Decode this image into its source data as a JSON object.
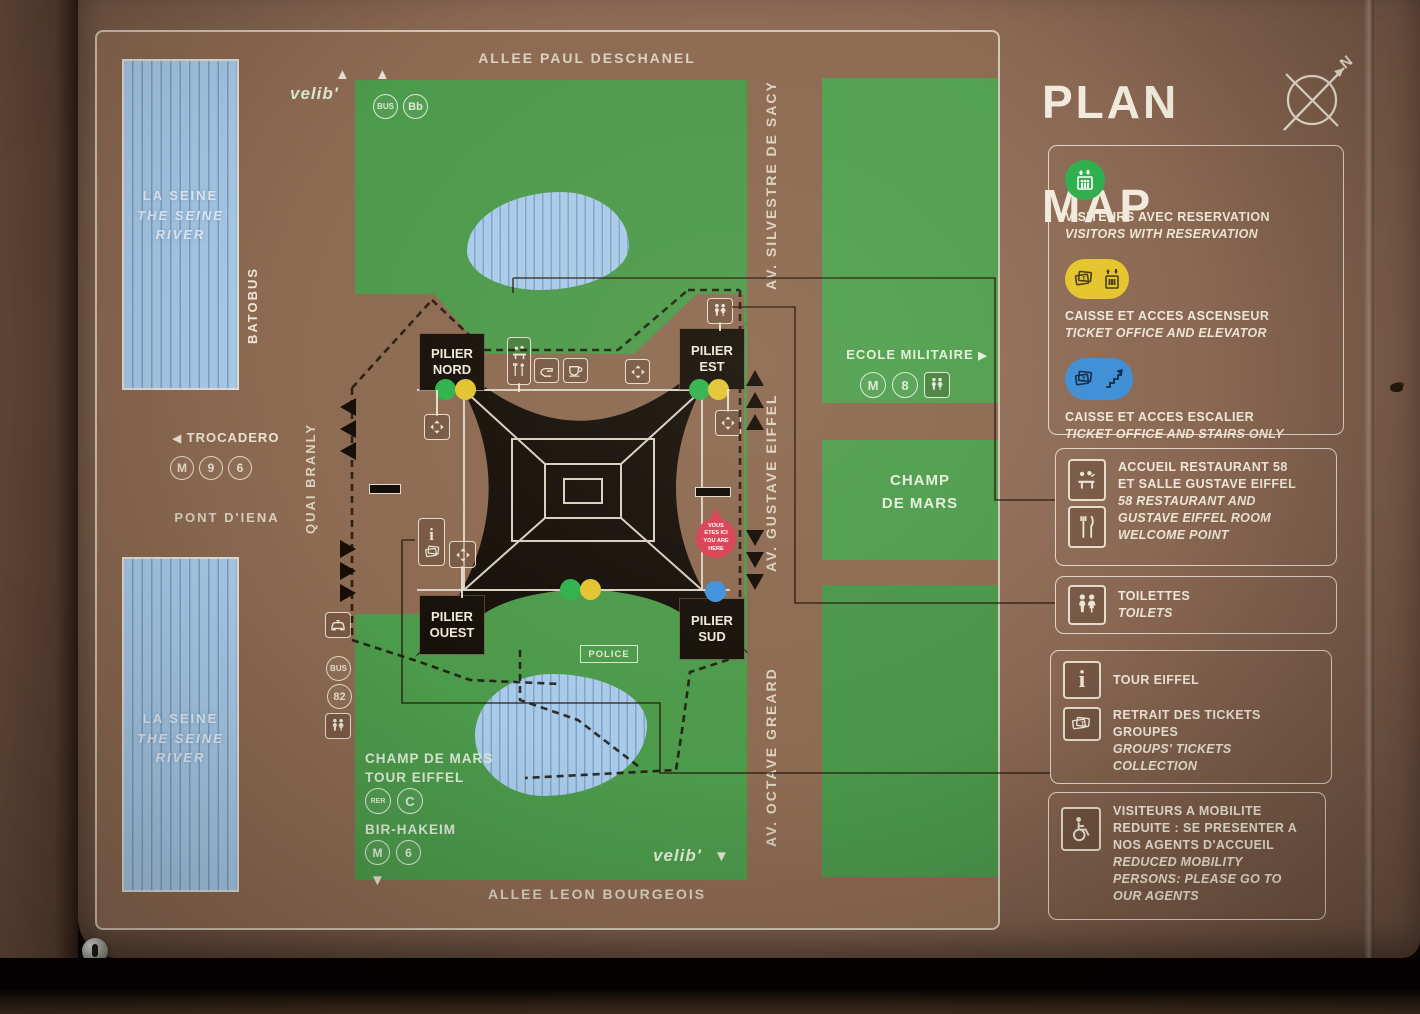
{
  "title": {
    "line1": "PLAN",
    "line2": "MAP",
    "compass_n": "N"
  },
  "colors": {
    "panel_brown": "#8a6853",
    "park_green": "#4c9a4b",
    "river_blue": "#a9cbe8",
    "tower_black": "#16100a",
    "cream": "#ece4d4",
    "dot_green": "#2eb24a",
    "dot_yellow": "#e3c430",
    "dot_blue": "#3e92dd",
    "marker_red": "#d94054"
  },
  "icons": {
    "arrow_left": "◀",
    "arrow_right": "▶",
    "arrow_up": "▲",
    "arrow_down": "▼",
    "info_glyph": "i"
  },
  "map": {
    "roads": {
      "allee_paul_deschanel": "ALLEE PAUL DESCHANEL",
      "allee_leon_bourgeois": "ALLEE LEON BOURGEOIS",
      "quai_branly": "QUAI BRANLY",
      "av_silvestre_de_sacy": "AV. SILVESTRE DE SACY",
      "av_gustave_eiffel": "AV. GUSTAVE EIFFEL",
      "av_octave_greard": "AV. OCTAVE GREARD",
      "pont_d_iena": "PONT D'IENA"
    },
    "river": {
      "line1": "LA SEINE",
      "line2": "THE SEINE",
      "line3": "RIVER",
      "batobus": "BATOBUS"
    },
    "transit": {
      "trocadero": {
        "label": "TROCADERO",
        "badges": [
          "M",
          "9",
          "6"
        ]
      },
      "ecole_militaire": {
        "label": "ECOLE MILITAIRE",
        "badges": [
          "M",
          "8"
        ]
      },
      "champ_de_mars_rer": {
        "line1": "CHAMP DE MARS",
        "line2": "TOUR EIFFEL",
        "badges": [
          "RER",
          "C"
        ]
      },
      "bir_hakeim": {
        "label": "BIR-HAKEIM",
        "badges": [
          "M",
          "6"
        ]
      },
      "bus_quai": {
        "badges": [
          "BUS",
          "82"
        ]
      },
      "bus_top": {
        "badges": [
          "BUS",
          "Bb"
        ]
      }
    },
    "areas": {
      "champ_de_mars": "CHAMP\nDE MARS"
    },
    "pillars": {
      "nord": "PILIER\nNORD",
      "est": "PILIER\nEST",
      "ouest": "PILIER\nOUEST",
      "sud": "PILIER\nSUD"
    },
    "police": "POLICE",
    "you_are_here": "VOUS\nETES ICI\nYOU ARE\nHERE",
    "velib": "velib'"
  },
  "legend": {
    "reservation": {
      "fr": "VISITEURS AVEC RESERVATION",
      "en": "VISITORS WITH RESERVATION"
    },
    "elevator": {
      "fr": "CAISSE ET ACCES ASCENSEUR",
      "en": "TICKET OFFICE AND ELEVATOR"
    },
    "stairs": {
      "fr": "CAISSE ET ACCES ESCALIER",
      "en": "TICKET OFFICE AND STAIRS ONLY"
    },
    "restaurant": {
      "fr": "ACCUEIL RESTAURANT 58\nET SALLE GUSTAVE EIFFEL",
      "en": "58 RESTAURANT AND\nGUSTAVE EIFFEL ROOM\nWELCOME POINT"
    },
    "toilets": {
      "fr": "TOILETTES",
      "en": "TOILETS"
    },
    "tour_eiffel": {
      "fr": "TOUR EIFFEL"
    },
    "groups": {
      "fr": "RETRAIT DES TICKETS\nGROUPES",
      "en": "GROUPS' TICKETS COLLECTION"
    },
    "mobility": {
      "fr": "VISITEURS A MOBILITE\nREDUITE : SE PRESENTER A\nNOS AGENTS D'ACCUEIL",
      "en": "REDUCED MOBILITY\nPERSONS: PLEASE GO TO\nOUR AGENTS"
    }
  }
}
